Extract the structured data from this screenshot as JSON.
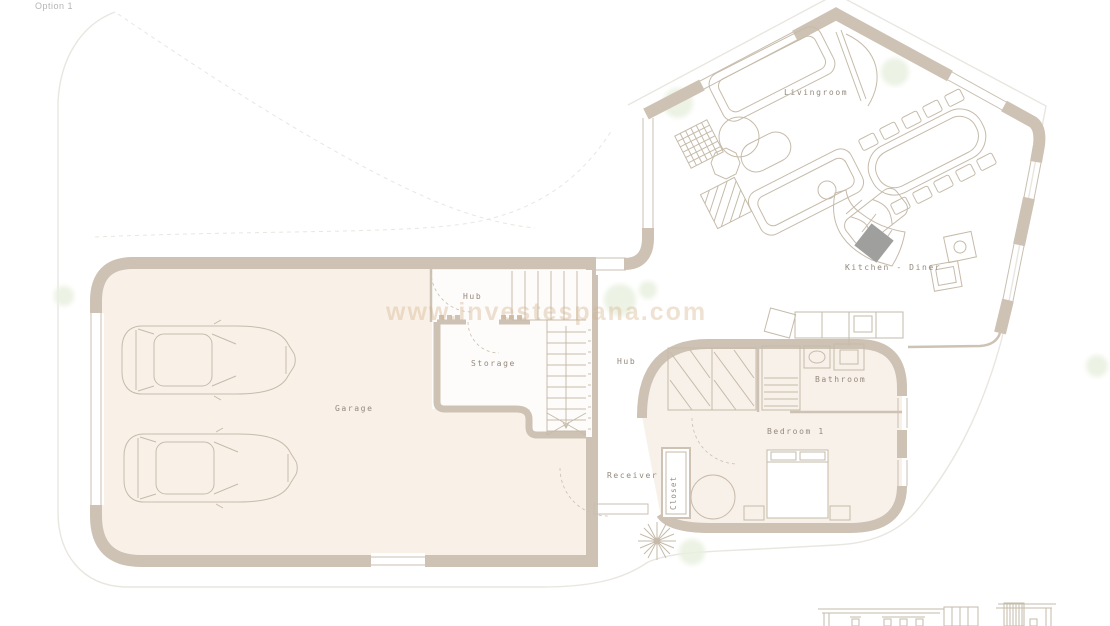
{
  "header": {
    "option_label": "Option 1"
  },
  "watermark": {
    "text": "www.investespana.com"
  },
  "rooms": {
    "livingroom": "Livingroom",
    "kitchen_diner": "Kitchen - Diner",
    "hub_upper": "Hub",
    "storage": "Storage",
    "garage": "Garage",
    "hub_lower": "Hub",
    "bathroom": "Bathroom",
    "bedroom1": "Bedroom 1",
    "receiver": "Receiver",
    "closet": "Closet"
  },
  "colors": {
    "wall": "#cdc2b3",
    "line": "#c9bfb1",
    "furn": "#c6bbaa",
    "floor_garage": "#f9f1e8",
    "floor_suite": "#f8f1ea",
    "site": "#e9e6e0",
    "plant": "#e9f0df",
    "label": "#94897d",
    "dark": "#9f9f9d",
    "watermark": "#d4b28a"
  }
}
